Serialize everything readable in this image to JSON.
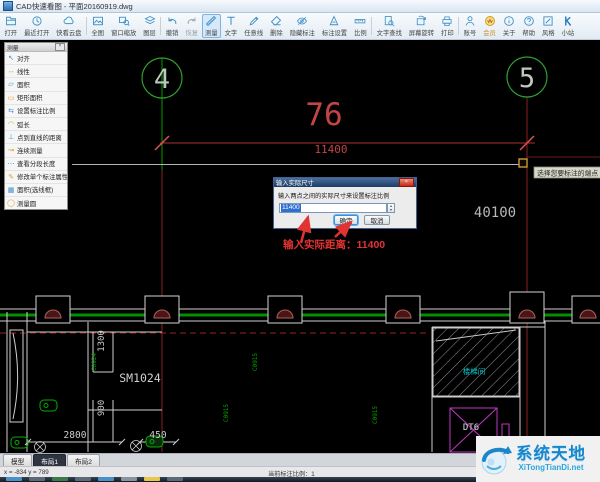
{
  "window": {
    "title": "CAD快速看图 - 平面20160919.dwg"
  },
  "toolbar": {
    "items": [
      {
        "label": "打开"
      },
      {
        "label": "最近打开"
      },
      {
        "label": "快看云盘"
      },
      {
        "label": "全图"
      },
      {
        "label": "窗口缩放"
      },
      {
        "label": "图层"
      },
      {
        "label": "撤销"
      },
      {
        "label": "恢复"
      },
      {
        "label": "测量"
      },
      {
        "label": "文字"
      },
      {
        "label": "任意线"
      },
      {
        "label": "删除"
      },
      {
        "label": "隐藏标注"
      },
      {
        "label": "标注设置"
      },
      {
        "label": "比例"
      },
      {
        "label": "文字查找"
      },
      {
        "label": "屏幕旋转"
      },
      {
        "label": "打印"
      },
      {
        "label": "账号"
      },
      {
        "label": "会员"
      },
      {
        "label": "关于"
      },
      {
        "label": "帮助"
      },
      {
        "label": "风格"
      },
      {
        "label": "小站"
      }
    ]
  },
  "menu": {
    "title": "测量",
    "close": "×",
    "items": [
      {
        "icon": "↖",
        "label": "对齐"
      },
      {
        "icon": "↔",
        "label": "线性"
      },
      {
        "icon": "▱",
        "label": "面积"
      },
      {
        "icon": "▭",
        "label": "矩形面积"
      },
      {
        "icon": "⇆",
        "label": "设置标注比例"
      },
      {
        "icon": "◠",
        "label": "弧长"
      },
      {
        "icon": "⊥",
        "label": "点到直线的距离"
      },
      {
        "icon": "↝",
        "label": "连续测量"
      },
      {
        "icon": "⋯",
        "label": "查看分段长度"
      },
      {
        "icon": "✎",
        "label": "修改单个标注属性"
      },
      {
        "icon": "▦",
        "label": "面积(选线框)"
      },
      {
        "icon": "◯",
        "label": "测量圆"
      }
    ]
  },
  "dialog": {
    "title": "输入实际尺寸",
    "close": "×",
    "prompt": "输入两点之间的实际尺寸来设置标注比例",
    "value": "11400",
    "spin_up": "▲",
    "spin_down": "▼",
    "ok": "确定",
    "cancel": "取消"
  },
  "drawing": {
    "bubble_left": "4",
    "bubble_right": "5",
    "dim_preview": "76",
    "dim_value": "11400",
    "right_dim": "40100",
    "tooltip": "选择您要标注的端点",
    "annotation": "输入实际距离：11400",
    "room_label": "SM1024",
    "stair_label": "楼梯间",
    "elevator_label": "DT6",
    "d1300": "1300",
    "d900": "900",
    "d2800": "2800",
    "d450": "450",
    "code1": "C0924",
    "code2": "C0915",
    "code3": "C0915",
    "code4": "C0915"
  },
  "statusbar": {
    "tabs": [
      {
        "label": "模型"
      },
      {
        "label": "布局1"
      },
      {
        "label": "布局2"
      }
    ],
    "coords": "x = -834  y = 789",
    "scale": "当前标注比例：1"
  },
  "watermark": {
    "name": "系统天地",
    "site": "XiTongTianDi.net"
  },
  "colors": {
    "accent_blue": "#3e8fc6",
    "cad_green": "#00a000",
    "cad_red": "#c24444",
    "cad_magenta": "#c238c2",
    "cad_cyan": "#00c8c8",
    "annotation_red": "#e23333",
    "selection_blue": "#2f6fd0",
    "vip_gold": "#d8a020"
  }
}
